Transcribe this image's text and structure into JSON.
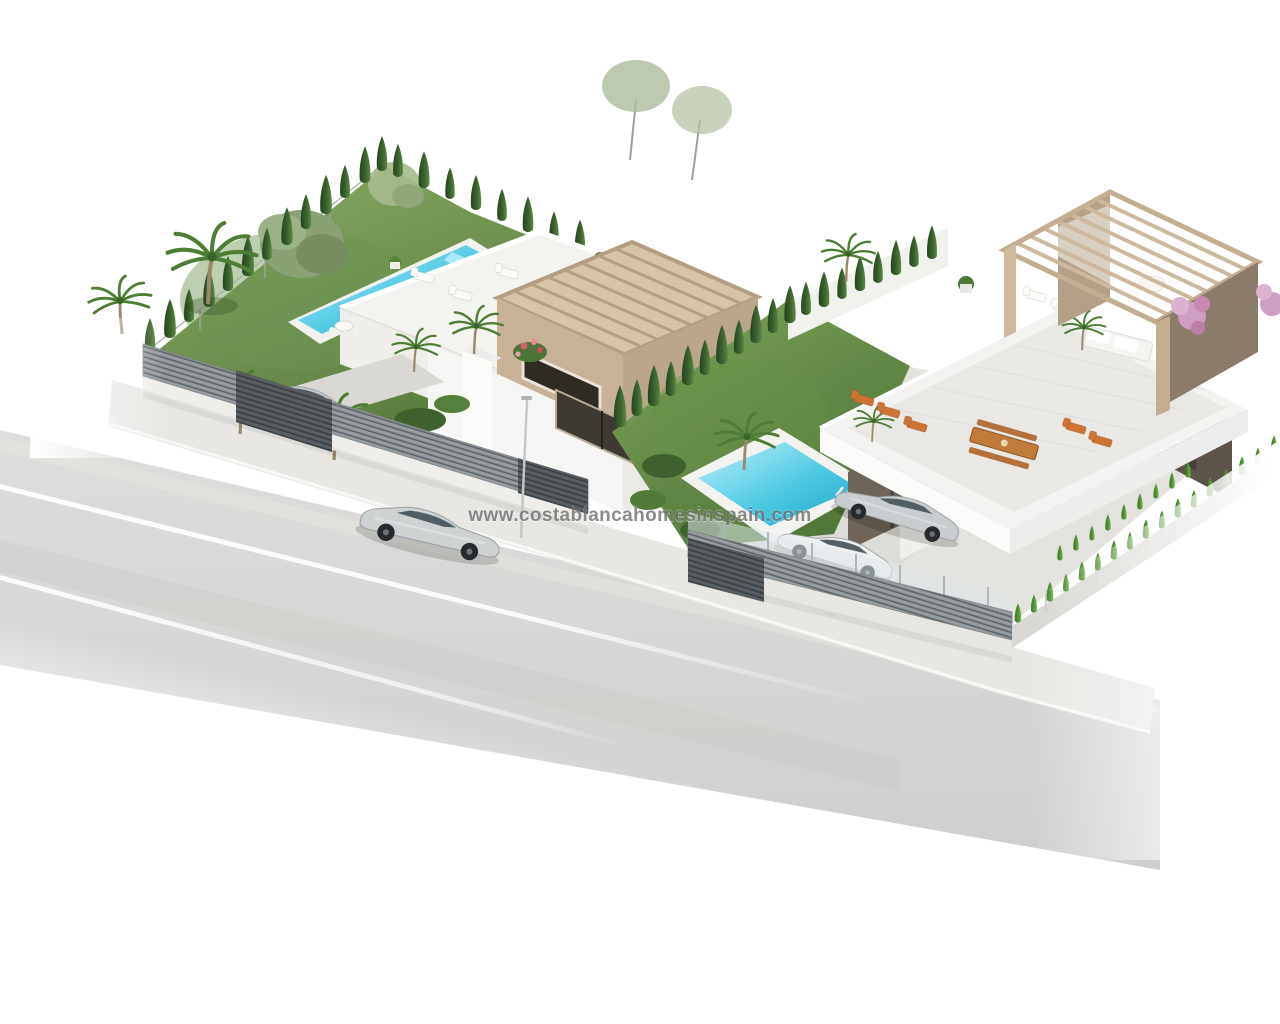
{
  "watermark": {
    "text": "www.costablancahomesinspain.com"
  },
  "colors": {
    "background": "#ffffff",
    "watermark_color": "#6f6f6f",
    "grass_light": "#85a85f",
    "grass_dark": "#5d8142",
    "pool_deep": "#25b3d6",
    "pool_light": "#bff0fa",
    "road": "#d5d5d3",
    "sidewalk": "#e7e6e3",
    "fence_slat_light": "#969c9f",
    "fence_slat_dark": "#5f6568",
    "gate_dark": "#44494c",
    "wall_white": "#f5f5f3",
    "pergola_wood": "#cdb99d",
    "pergola_wall_brown": "#8b7b6b",
    "villa_dark_wall": "#6e6459",
    "window_dark": "#3c372f",
    "cypress_green": "#3c6330",
    "hedge_bright": "#569638",
    "palm_green": "#4e7d36",
    "olive_green": "#8aa075",
    "car_silver": "#c9cdcf",
    "car_white": "#eef0ef",
    "lounger_orange": "#cd7434",
    "wood_table": "#c07a39",
    "flower_pink": "#cf9ec2"
  },
  "scene": {
    "objects": [
      "left-villa",
      "left-villa-pergola",
      "left-roof-terrace",
      "left-garden-lawn",
      "left-lap-pool",
      "left-carport-cars",
      "left-street-fence",
      "left-gate",
      "right-villa",
      "right-villa-pergola",
      "right-roof-terrace",
      "right-garden-lawn",
      "right-pool",
      "right-patio-loungers",
      "right-picnic-table",
      "right-driveway-cars",
      "right-street-fence",
      "cypress-hedges",
      "palm-trees",
      "olive-tree",
      "pink-flowering-shrub",
      "street-road",
      "sidewalk",
      "lane-markings",
      "driving-car",
      "street-lamp"
    ]
  }
}
